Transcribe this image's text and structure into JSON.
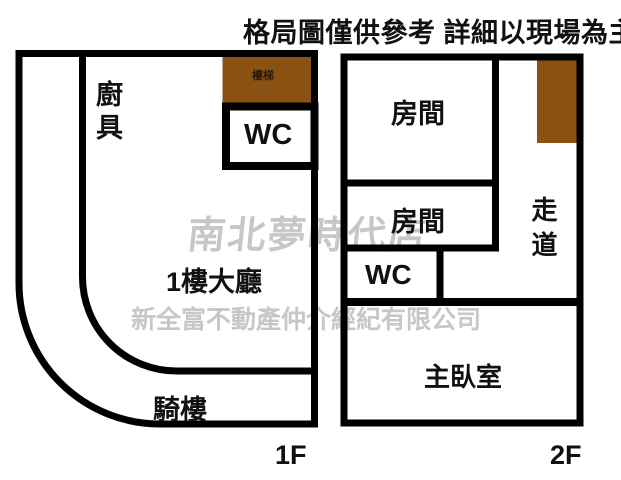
{
  "title": "格局圖僅供參考 詳細以現場為主",
  "watermarks": {
    "store": "南北夢時代店",
    "company": "新全富不動產仲介經紀有限公司"
  },
  "colors": {
    "wall": "#000000",
    "text": "#111111",
    "stairs_brown": "#8a5212",
    "stairs_label": "#2b1a06",
    "watermark_gray": "#c7c7c7",
    "background": "#ffffff"
  },
  "floor1": {
    "label": "1F",
    "rooms": {
      "kitchen": "廚具",
      "stairs": "樓梯",
      "wc": "WC",
      "hall": "1樓大廳",
      "arcade": "騎樓"
    }
  },
  "floor2": {
    "label": "2F",
    "rooms": {
      "room_top": "房間",
      "room_mid": "房間",
      "corridor": "走道",
      "wc": "WC",
      "master": "主臥室"
    }
  }
}
